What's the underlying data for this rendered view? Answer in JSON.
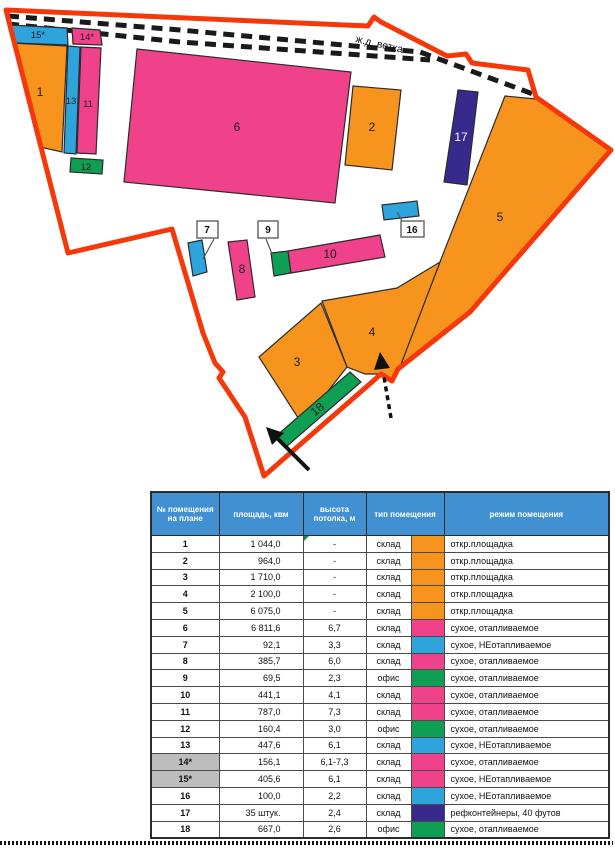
{
  "plan": {
    "railway_label": "ж.д. ветка",
    "labels": {
      "l1": "1",
      "l2": "2",
      "l3": "3",
      "l4": "4",
      "l5": "5",
      "l6": "6",
      "l7": "7",
      "l8": "8",
      "l9": "9",
      "l10": "10",
      "l11": "11",
      "l12": "12",
      "l13": "13",
      "l14": "14*",
      "l15": "15*",
      "l16": "16",
      "l17": "17",
      "l18": "18"
    },
    "colors": {
      "orange": "#F7941E",
      "pink": "#F0428A",
      "blue": "#2FA3DC",
      "green": "#0E9E54",
      "indigo": "#38298C",
      "boundary": "#F5380A",
      "header_blue": "#4190D2",
      "gray_row": "#BDBDBD"
    }
  },
  "table": {
    "headers": [
      "№ помещения на плане",
      "площадь, квм",
      "высота потолка, м",
      "тип помещения",
      "режим помещения"
    ],
    "rows": [
      {
        "num": "1",
        "area": "1 044,0",
        "height": "-",
        "type": "склад",
        "color": "orange",
        "mode": "откр.площадка",
        "gray": false,
        "marker": true
      },
      {
        "num": "2",
        "area": "964,0",
        "height": "-",
        "type": "склад",
        "color": "orange",
        "mode": "откр.площадка",
        "gray": false,
        "marker": false
      },
      {
        "num": "3",
        "area": "1 710,0",
        "height": "-",
        "type": "склад",
        "color": "orange",
        "mode": "откр.площадка",
        "gray": false,
        "marker": false
      },
      {
        "num": "4",
        "area": "2 100,0",
        "height": "-",
        "type": "склад",
        "color": "orange",
        "mode": "откр.площадка",
        "gray": false,
        "marker": false
      },
      {
        "num": "5",
        "area": "6 075,0",
        "height": "-",
        "type": "склад",
        "color": "orange",
        "mode": "откр.площадка",
        "gray": false,
        "marker": false
      },
      {
        "num": "6",
        "area": "6 811,6",
        "height": "6,7",
        "type": "склад",
        "color": "pink",
        "mode": "сухое, отапливаемое",
        "gray": false,
        "marker": false
      },
      {
        "num": "7",
        "area": "92,1",
        "height": "3,3",
        "type": "склад",
        "color": "blue",
        "mode": "сухое, НЕотапливаемое",
        "gray": false,
        "marker": false
      },
      {
        "num": "8",
        "area": "385,7",
        "height": "6,0",
        "type": "склад",
        "color": "pink",
        "mode": "сухое, отапливаемое",
        "gray": false,
        "marker": false
      },
      {
        "num": "9",
        "area": "69,5",
        "height": "2,3",
        "type": "офис",
        "color": "green",
        "mode": "сухое, отапливаемое",
        "gray": false,
        "marker": false
      },
      {
        "num": "10",
        "area": "441,1",
        "height": "4,1",
        "type": "склад",
        "color": "pink",
        "mode": "сухое, отапливаемое",
        "gray": false,
        "marker": false
      },
      {
        "num": "11",
        "area": "787,0",
        "height": "7,3",
        "type": "склад",
        "color": "pink",
        "mode": "сухое, отапливаемое",
        "gray": false,
        "marker": false
      },
      {
        "num": "12",
        "area": "160,4",
        "height": "3,0",
        "type": "офис",
        "color": "green",
        "mode": "сухое, отапливаемое",
        "gray": false,
        "marker": false
      },
      {
        "num": "13",
        "area": "447,6",
        "height": "6,1",
        "type": "склад",
        "color": "blue",
        "mode": "сухое, НЕотапливаемое",
        "gray": false,
        "marker": false
      },
      {
        "num": "14*",
        "area": "156,1",
        "height": "6,1-7,3",
        "type": "склад",
        "color": "pink",
        "mode": "сухое, отапливаемое",
        "gray": true,
        "marker": false
      },
      {
        "num": "15*",
        "area": "405,6",
        "height": "6,1",
        "type": "склад",
        "color": "pink",
        "mode": "сухое, НЕотапливаемое",
        "gray": true,
        "marker": false
      },
      {
        "num": "16",
        "area": "100,0",
        "height": "2,2",
        "type": "склад",
        "color": "blue",
        "mode": "сухое, НЕотапливаемое",
        "gray": false,
        "marker": false
      },
      {
        "num": "17",
        "area": "35 штук.",
        "height": "2,4",
        "type": "склад",
        "color": "indigo",
        "mode": "рефконтейнеры, 40 футов",
        "gray": false,
        "marker": false
      },
      {
        "num": "18",
        "area": "667,0",
        "height": "2,6",
        "type": "офис",
        "color": "green",
        "mode": "сухое, отапливаемое",
        "gray": false,
        "marker": false
      }
    ]
  }
}
